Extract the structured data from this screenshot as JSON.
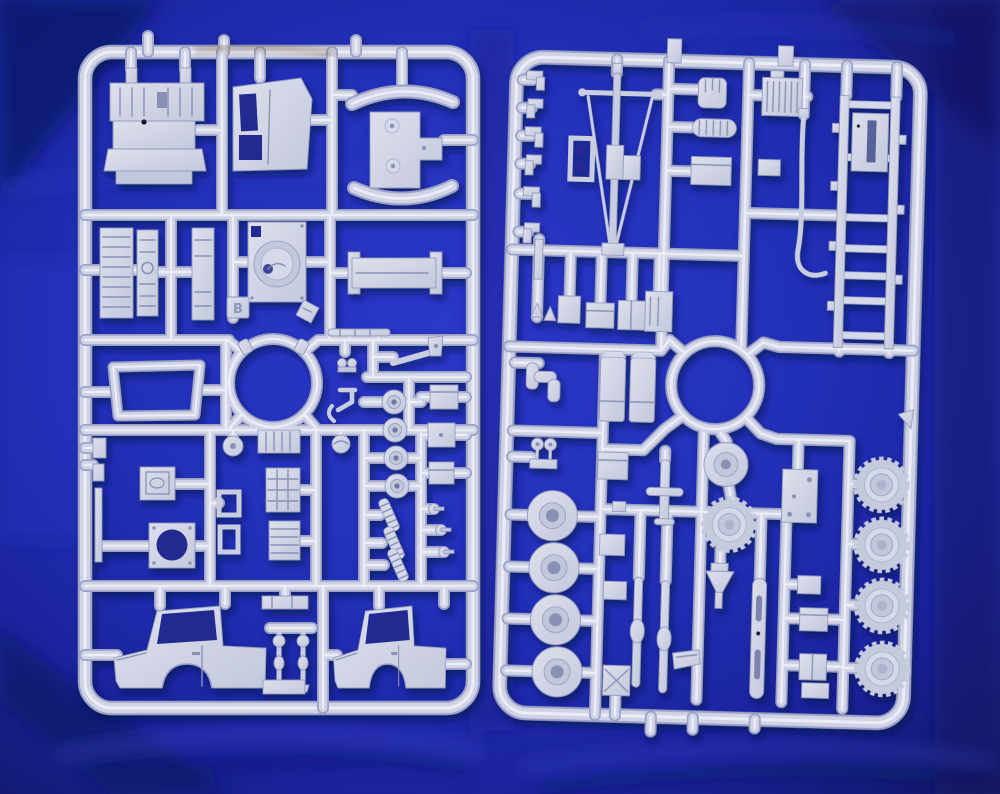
{
  "image": {
    "kind": "photograph",
    "title": "Two plastic model-kit sprues on blue fabric",
    "description": "Two light grey injection-moulded polystyrene sprues from a truck model kit lying side by side on wrinkled royal-blue fabric. The left sprue holds cab and engine parts, the right sprue holds chassis, wheel and tyre parts.",
    "sprue_count": "2"
  },
  "palette": {
    "fabric_blue": "#2230bc",
    "fabric_shadow": "#10165e",
    "fabric_highlight": "#3d47d2",
    "plastic_mid": "#cfd3e5",
    "plastic_edge": "#9aa1c4",
    "plastic_highlight": "#ebedf6",
    "stain_brown": "#7d5c3e"
  },
  "left_sprue": {
    "letter": "B",
    "parts": [
      "engine block with ribbed head",
      "cab rear panel with two window openings",
      "fender pair with E-shaped mounting plate",
      "radiator grille panels (3)",
      "fan housing panel with rotor disc",
      "cargo floor tray",
      "windscreen frame",
      "large circular runner ring",
      "detail rod and control levers",
      "gauge with needle",
      "battery box",
      "clamp ring with round opening",
      "grid vent box and ribbed boxes",
      "pulleys (4)",
      "coil springs (3)",
      "equipment boxes (3)",
      "ball joint pins (3)",
      "cab side panel left",
      "cab side panel right",
      "steering knuckles (2)",
      "gate tab letter B"
    ]
  },
  "right_sprue": {
    "marking": "triangular gate tab",
    "parts": [
      "A-frame mast and tow-bar assembly",
      "edge clips and hooks (6)",
      "slotted bracket frame",
      "seat cushion part",
      "ribbed radiator with filler cap",
      "ribbed muffler",
      "stowage boxes",
      "curved exhaust pipe",
      "ladder chassis frame with crossmembers",
      "radiator core plate",
      "large circular runner ring",
      "fuel tank pair",
      "pipe elbow fittings",
      "air horns",
      "road wheels (4)",
      "spare wheel disc",
      "wheel with treaded tyre",
      "funnel",
      "leaf springs",
      "slotted leaf spring",
      "floor plate with bolt holes",
      "treaded tyres (4)"
    ]
  }
}
